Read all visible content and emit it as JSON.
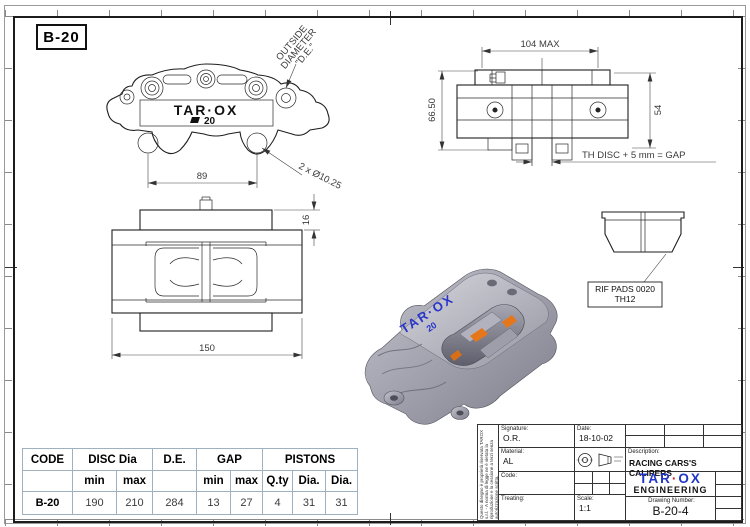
{
  "sheet": {
    "zone_label": "B-20"
  },
  "views": {
    "front": {
      "logo": "TAR·OX",
      "model_num": "20",
      "dim_span": "89",
      "callout_outside_1": "OUTSIDE",
      "callout_outside_2": "DIAMETER",
      "callout_outside_3": "\"D.E.\"",
      "callout_holes": "2 x Ø10.25"
    },
    "end": {
      "dim_width": "104 MAX",
      "dim_height_left": "66.50",
      "dim_height_right": "54",
      "gap_note": "TH DISC + 5 mm = GAP"
    },
    "bottom": {
      "dim_length": "150",
      "dim_tab": "16"
    },
    "pad": {
      "ref_line1": "RIF PADS 0020",
      "ref_line2": "TH12"
    },
    "render3d": {
      "engraving_logo": "TAR·OX",
      "engraving_num": "20"
    }
  },
  "spec_table": {
    "headers": {
      "code": "CODE",
      "disc_dia": "DISC Dia",
      "de": "D.E.",
      "gap": "GAP",
      "pistons": "PISTONS"
    },
    "subheaders": {
      "disc_min": "min",
      "disc_max": "max",
      "gap_min": "min",
      "gap_max": "max",
      "qty": "Q.ty",
      "dia1": "Dia.",
      "dia2": "Dia."
    },
    "row": {
      "code": "B-20",
      "disc_min": "190",
      "disc_max": "210",
      "de": "284",
      "gap_min": "13",
      "gap_max": "27",
      "qty": "4",
      "dia1": "31",
      "dia2": "31"
    }
  },
  "title_block": {
    "signature_label": "Signature:",
    "signature_value": "O.R.",
    "date_label": "Date:",
    "date_value": "18-10-02",
    "material_label": "Material:",
    "material_value": "AL",
    "code_label": "Code:",
    "treating_label": "Treating:",
    "scale_label": "Scale:",
    "scale_value": "1:1",
    "description_label": "Description:",
    "description_value": "RACING CARS'S CALIPERS",
    "brand_tar": "TAR",
    "brand_dot": "·",
    "brand_ox": "OX",
    "brand_sub": "ENGINEERING",
    "drawing_number_label": "Drawing Number:",
    "drawing_number_value": "B-20-4",
    "side_note": "Questo disegno è proprietà riservata TAROX s.r.l. - A norma di legge ne è vietata la riproduzione e la cessione a terzi senza autorizzazione scritta."
  },
  "colors": {
    "line": "#1e1e1e",
    "grid_blue": "#9fb0bf",
    "brand_blue": "#1f36c9",
    "brand_red": "#cf2020",
    "engraving_blue": "#2a35c8",
    "pad_orange": "#e6761a",
    "metal_grey": "#9a9aa6"
  }
}
